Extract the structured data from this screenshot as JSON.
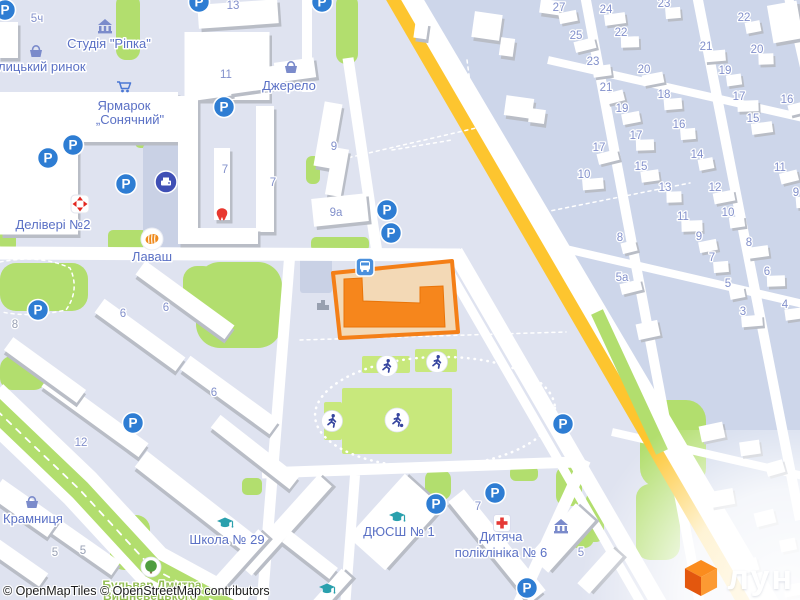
{
  "attribution": {
    "text": "© OpenMapTiles © OpenStreetMap contributors"
  },
  "logo": {
    "text": "лун"
  },
  "map": {
    "colors": {
      "bg": "#dfe3f0",
      "bg2": "#cdd6ea",
      "lot": "#c9d1e5",
      "road": "#ffffff",
      "green": "#b2de6e",
      "field": "#c8e87c",
      "yellow": "#fdc52f",
      "building": "#ffffff",
      "building_shadow": "#b9bdc6",
      "plot_fill": "#f3d9b6",
      "plot_border": "#f47f17",
      "selected_building": "#f6861c",
      "parking_blue": "#2e7dd3",
      "bus_blue": "#4a90dd",
      "poi_slate": "#7b8bcb",
      "cap_teal": "#2aa0ad",
      "red": "#e2261f",
      "navy": "#3f4fb5",
      "figure_navy": "#36459f",
      "label_blue": "#5b71c5",
      "number_blue": "#8290cb",
      "street_green": "#93be53"
    },
    "glyphs": {
      "parking": "P"
    },
    "private_area": "394,-8 810,-8 810,610 752,610",
    "gray_areas": [
      {
        "x": 143,
        "y": 145,
        "w": 45,
        "h": 105
      },
      {
        "x": 300,
        "y": 257,
        "w": 32,
        "h": 36
      }
    ],
    "greens": [
      {
        "x": 336,
        "y": -6,
        "w": 22,
        "h": 70,
        "rx": 10
      },
      {
        "x": 116,
        "y": -6,
        "w": 24,
        "h": 66,
        "rx": 10
      },
      {
        "x": 135,
        "y": 136,
        "w": 30,
        "h": 12,
        "rx": 5
      },
      {
        "x": 196,
        "y": 262,
        "w": 86,
        "h": 86,
        "rx": 24
      },
      {
        "x": 183,
        "y": 266,
        "w": 34,
        "h": 40,
        "rx": 14
      },
      {
        "x": 0,
        "y": 263,
        "w": 88,
        "h": 48,
        "rx": 16
      },
      {
        "x": 0,
        "y": 198,
        "w": 16,
        "h": 54,
        "rx": 7
      },
      {
        "x": 108,
        "y": 230,
        "w": 82,
        "h": 21,
        "rx": 5
      },
      {
        "x": 311,
        "y": 237,
        "w": 58,
        "h": 14,
        "rx": 5
      },
      {
        "x": 306,
        "y": 156,
        "w": 14,
        "h": 28,
        "rx": 6
      },
      {
        "x": 0,
        "y": 356,
        "w": 46,
        "h": 34,
        "rx": 12
      },
      {
        "x": 110,
        "y": 515,
        "w": 40,
        "h": 55,
        "rx": 14
      },
      {
        "x": 242,
        "y": 478,
        "w": 20,
        "h": 17,
        "rx": 5
      },
      {
        "x": 425,
        "y": 470,
        "w": 26,
        "h": 30,
        "rx": 9
      },
      {
        "x": 510,
        "y": 466,
        "w": 28,
        "h": 15,
        "rx": 6
      },
      {
        "x": 556,
        "y": 466,
        "w": 26,
        "h": 40,
        "rx": 10
      },
      {
        "x": 568,
        "y": 516,
        "w": 26,
        "h": 32,
        "rx": 10
      },
      {
        "x": 640,
        "y": 400,
        "w": 66,
        "h": 88,
        "rx": 20
      },
      {
        "x": 636,
        "y": 484,
        "w": 44,
        "h": 76,
        "rx": 14
      },
      {
        "x": 586,
        "y": 492,
        "w": 18,
        "h": 50,
        "rx": 8
      }
    ],
    "roads": [
      {
        "d": "M-5,253 L460,255",
        "w": 13
      },
      {
        "d": "M348,58 L377,253",
        "w": 11
      },
      {
        "d": "M307,-5 L307,92",
        "w": 10
      },
      {
        "d": "M290,252 L262,605",
        "w": 11
      },
      {
        "d": "M355,475 L345,608",
        "w": 10
      },
      {
        "d": "M262,473 L577,462",
        "w": 11
      },
      {
        "d": "M438,252 L642,605",
        "w": 9
      },
      {
        "d": "M455,252 L660,605",
        "w": 16
      },
      {
        "d": "M515,612 L585,460",
        "w": 12
      },
      {
        "d": "M585,-5 L700,605",
        "w": 10
      },
      {
        "d": "M697,-5 L800,520",
        "w": 10
      },
      {
        "d": "M788,-5 L812,100",
        "w": 9
      },
      {
        "d": "M548,60 L812,120",
        "w": 8
      },
      {
        "d": "M553,246 L812,306",
        "w": 8
      },
      {
        "d": "M612,432 L812,478",
        "w": 8
      },
      {
        "d": "M-12,400 L80,488 L152,566 L240,614",
        "w": 44
      },
      {
        "d": "M-12,402 L80,490 L152,568 L238,614",
        "w": 21,
        "c": "green"
      },
      {
        "d": "M402,-8 L766,608",
        "w": 30
      },
      {
        "d": "M389,-8 L747,608",
        "w": 13,
        "c": "yellow"
      },
      {
        "d": "M597,312 L662,452",
        "w": 13,
        "c": "green"
      }
    ],
    "dashes": [
      {
        "d": "M-12,402 L80,490 L152,568 L238,614",
        "w": 1.8,
        "da": "6 7"
      },
      {
        "d": "M467,60 L476,128 L330,162",
        "w": 1.5,
        "da": "3 4"
      },
      {
        "d": "M545,212 L690,183",
        "w": 1.5,
        "da": "3 4"
      },
      {
        "d": "M300,340 L566,332",
        "w": 1.5,
        "da": "3 4"
      },
      {
        "d": "M0,262 Q40,254 70,268 Q80,290 66,310 Q30,318 2,312",
        "w": 1.5,
        "da": "3 4"
      },
      {
        "d": "M392,150 L452,140",
        "w": 1.5,
        "da": "3 4"
      }
    ],
    "buildings": [
      {
        "cx": 89,
        "cy": 117,
        "w": 178,
        "h": 50,
        "r": 0
      },
      {
        "cx": 39,
        "cy": 187,
        "w": 78,
        "h": 95,
        "r": 0
      },
      {
        "cx": 8,
        "cy": 40,
        "w": 20,
        "h": 36,
        "r": 0
      },
      {
        "cx": 227,
        "cy": 66,
        "w": 85,
        "h": 68,
        "r": 0
      },
      {
        "cx": 238,
        "cy": 14,
        "w": 80,
        "h": 24,
        "r": -4
      },
      {
        "cx": 188,
        "cy": 170,
        "w": 20,
        "h": 148,
        "r": 0
      },
      {
        "cx": 265,
        "cy": 169,
        "w": 18,
        "h": 126,
        "r": 0
      },
      {
        "cx": 228,
        "cy": 236,
        "w": 60,
        "h": 16,
        "r": 0
      },
      {
        "cx": 222,
        "cy": 184,
        "w": 16,
        "h": 72,
        "r": 0
      },
      {
        "cx": 213,
        "cy": 84,
        "w": 34,
        "h": 28,
        "r": -8
      },
      {
        "cx": 252,
        "cy": 80,
        "w": 50,
        "h": 22,
        "r": -8
      },
      {
        "cx": 295,
        "cy": 70,
        "w": 40,
        "h": 20,
        "r": -8
      },
      {
        "cx": 328,
        "cy": 135,
        "w": 18,
        "h": 65,
        "r": 10
      },
      {
        "cx": 337,
        "cy": 172,
        "w": 16,
        "h": 48,
        "r": 10
      },
      {
        "cx": 340,
        "cy": 210,
        "w": 55,
        "h": 28,
        "r": -6
      },
      {
        "cx": 487,
        "cy": 26,
        "w": 28,
        "h": 26,
        "r": 8
      },
      {
        "cx": 507,
        "cy": 47,
        "w": 14,
        "h": 18,
        "r": 8
      },
      {
        "cx": 421,
        "cy": 30,
        "w": 13,
        "h": 17,
        "r": 8
      },
      {
        "cx": 519,
        "cy": 107,
        "w": 28,
        "h": 20,
        "r": 8
      },
      {
        "cx": 537,
        "cy": 116,
        "w": 16,
        "h": 14,
        "r": 8
      },
      {
        "cx": 550,
        "cy": 7,
        "w": 20,
        "h": 14,
        "r": 8
      },
      {
        "cx": 785,
        "cy": 22,
        "w": 30,
        "h": 38,
        "r": -10
      },
      {
        "cx": 185,
        "cy": 300,
        "w": 110,
        "h": 17,
        "r": 36
      },
      {
        "cx": 140,
        "cy": 335,
        "w": 100,
        "h": 17,
        "r": 36
      },
      {
        "cx": 230,
        "cy": 395,
        "w": 110,
        "h": 17,
        "r": 36
      },
      {
        "cx": 95,
        "cy": 415,
        "w": 120,
        "h": 17,
        "r": 36
      },
      {
        "cx": 45,
        "cy": 370,
        "w": 90,
        "h": 16,
        "r": 36
      },
      {
        "cx": 75,
        "cy": 540,
        "w": 100,
        "h": 16,
        "r": 35
      },
      {
        "cx": 15,
        "cy": 560,
        "w": 70,
        "h": 16,
        "r": 35
      },
      {
        "cx": 25,
        "cy": 508,
        "w": 70,
        "h": 22,
        "r": 35
      },
      {
        "cx": 200,
        "cy": 505,
        "w": 150,
        "h": 20,
        "r": 38
      },
      {
        "cx": 255,
        "cy": 452,
        "w": 100,
        "h": 16,
        "r": 38
      },
      {
        "cx": 285,
        "cy": 525,
        "w": 120,
        "h": 18,
        "r": -48
      },
      {
        "cx": 240,
        "cy": 560,
        "w": 70,
        "h": 14,
        "r": -48
      },
      {
        "cx": 310,
        "cy": 555,
        "w": 60,
        "h": 14,
        "r": 38
      },
      {
        "cx": 330,
        "cy": 592,
        "w": 50,
        "h": 14,
        "r": -48
      },
      {
        "cx": 395,
        "cy": 522,
        "w": 85,
        "h": 50,
        "r": -48
      },
      {
        "cx": 497,
        "cy": 546,
        "w": 130,
        "h": 20,
        "r": 51
      },
      {
        "cx": 562,
        "cy": 538,
        "w": 70,
        "h": 26,
        "r": -48
      },
      {
        "cx": 600,
        "cy": 570,
        "w": 50,
        "h": 16,
        "r": -48
      }
    ],
    "houses": [
      {
        "cx": 712,
        "cy": 432,
        "w": 24,
        "h": 16,
        "r": -12
      },
      {
        "cx": 750,
        "cy": 448,
        "w": 20,
        "h": 14,
        "r": -8
      },
      {
        "cx": 775,
        "cy": 468,
        "w": 18,
        "h": 13,
        "r": -16
      },
      {
        "cx": 722,
        "cy": 498,
        "w": 24,
        "h": 16,
        "r": -10
      },
      {
        "cx": 765,
        "cy": 518,
        "w": 20,
        "h": 14,
        "r": -14
      },
      {
        "cx": 788,
        "cy": 545,
        "w": 16,
        "h": 12,
        "r": -12
      },
      {
        "cx": 748,
        "cy": 566,
        "w": 20,
        "h": 13,
        "r": -16
      },
      {
        "cx": 793,
        "cy": 590,
        "w": 18,
        "h": 12,
        "r": -10
      },
      {
        "cx": 648,
        "cy": 330,
        "w": 22,
        "h": 16,
        "r": -12
      }
    ],
    "selection": {
      "plot": "333,273 452,261 458,332 340,338",
      "building": "344,279 362,278 363,301 420,303 420,287 443,286 445,327 344,327"
    },
    "stadium": {
      "track": {
        "cx": 435,
        "cy": 412,
        "rx": 120,
        "ry": 55,
        "rot": -2
      },
      "fields": [
        {
          "x": 342,
          "y": 388,
          "w": 110,
          "h": 66
        },
        {
          "x": 362,
          "y": 356,
          "w": 48,
          "h": 17
        },
        {
          "x": 415,
          "y": 349,
          "w": 42,
          "h": 23
        },
        {
          "x": 324,
          "y": 402,
          "w": 18,
          "h": 38
        }
      ]
    },
    "icons": [
      {
        "t": "parking",
        "x": 5,
        "y": 10
      },
      {
        "t": "parking",
        "x": 199,
        "y": 2
      },
      {
        "t": "parking",
        "x": 322,
        "y": 2
      },
      {
        "t": "parking",
        "x": 224,
        "y": 107
      },
      {
        "t": "parking",
        "x": 73,
        "y": 145
      },
      {
        "t": "parking",
        "x": 48,
        "y": 158
      },
      {
        "t": "parking",
        "x": 126,
        "y": 184
      },
      {
        "t": "parking",
        "x": 387,
        "y": 210
      },
      {
        "t": "parking",
        "x": 391,
        "y": 233
      },
      {
        "t": "parking",
        "x": 38,
        "y": 310
      },
      {
        "t": "parking",
        "x": 133,
        "y": 423
      },
      {
        "t": "parking",
        "x": 563,
        "y": 424
      },
      {
        "t": "parking",
        "x": 436,
        "y": 504
      },
      {
        "t": "parking",
        "x": 495,
        "y": 493
      },
      {
        "t": "parking",
        "x": 527,
        "y": 588
      },
      {
        "t": "bus",
        "x": 365,
        "y": 267
      },
      {
        "t": "basket",
        "x": 36,
        "y": 51
      },
      {
        "t": "basket",
        "x": 291,
        "y": 67
      },
      {
        "t": "basket",
        "x": 32,
        "y": 502
      },
      {
        "t": "museum",
        "x": 105,
        "y": 27
      },
      {
        "t": "museum",
        "x": 561,
        "y": 527
      },
      {
        "t": "cart",
        "x": 124,
        "y": 87
      },
      {
        "t": "cap",
        "x": 225,
        "y": 523
      },
      {
        "t": "cap",
        "x": 397,
        "y": 517
      },
      {
        "t": "cap",
        "x": 327,
        "y": 589
      },
      {
        "t": "cross",
        "x": 502,
        "y": 523
      },
      {
        "t": "tooth",
        "x": 222,
        "y": 214
      },
      {
        "t": "tree",
        "x": 151,
        "y": 567
      },
      {
        "t": "printer",
        "x": 166,
        "y": 182
      },
      {
        "t": "delivery",
        "x": 80,
        "y": 204
      },
      {
        "t": "food",
        "x": 152,
        "y": 239
      },
      {
        "t": "runner",
        "x": 387,
        "y": 366
      },
      {
        "t": "runner",
        "x": 437,
        "y": 362
      },
      {
        "t": "runner",
        "x": 332,
        "y": 421
      },
      {
        "t": "footballer",
        "x": 397,
        "y": 420
      },
      {
        "t": "graybuilding",
        "x": 323,
        "y": 304
      }
    ],
    "labels": [
      {
        "text": "Студія \"Ріпка\"",
        "x": 109,
        "y": 48
      },
      {
        "text": "Галицький ринок",
        "x": 35,
        "y": 71
      },
      {
        "text": "Ярмарок",
        "x": 124,
        "y": 110
      },
      {
        "text": "„Сонячний\"",
        "x": 130,
        "y": 124
      },
      {
        "text": "Джерело",
        "x": 289,
        "y": 90
      },
      {
        "text": "Делівері №2",
        "x": 53,
        "y": 229
      },
      {
        "text": "Лаваш",
        "x": 152,
        "y": 261
      },
      {
        "text": "Крамниця",
        "x": 33,
        "y": 523
      },
      {
        "text": "Школа № 29",
        "x": 227,
        "y": 544
      },
      {
        "text": "ДЮСШ № 1",
        "x": 399,
        "y": 536
      },
      {
        "text": "Дитяча",
        "x": 501,
        "y": 541
      },
      {
        "text": "поліклініка № 6",
        "x": 501,
        "y": 557
      }
    ],
    "streets": [
      {
        "text": "Бульвар Дмитра",
        "x": 152,
        "y": 589
      },
      {
        "text": "Вишневецького",
        "x": 150,
        "y": 600
      }
    ],
    "numbers": [
      {
        "t": "5ч",
        "x": 37,
        "y": 22
      },
      {
        "t": "13",
        "x": 233,
        "y": 9
      },
      {
        "t": "11",
        "x": 226,
        "y": 78
      },
      {
        "t": "9",
        "x": 334,
        "y": 150
      },
      {
        "t": "9а",
        "x": 336,
        "y": 216
      },
      {
        "t": "7",
        "x": 225,
        "y": 173
      },
      {
        "t": "7",
        "x": 273,
        "y": 186
      },
      {
        "t": "6",
        "x": 123,
        "y": 317
      },
      {
        "t": "6",
        "x": 166,
        "y": 311
      },
      {
        "t": "6",
        "x": 214,
        "y": 396
      },
      {
        "t": "8",
        "x": 15,
        "y": 328,
        "g": 1
      },
      {
        "t": "12",
        "x": 81,
        "y": 446
      },
      {
        "t": "7",
        "x": 478,
        "y": 510
      },
      {
        "t": "5",
        "x": 581,
        "y": 556
      },
      {
        "t": "5",
        "x": 55,
        "y": 556,
        "g": 1
      },
      {
        "t": "5",
        "x": 83,
        "y": 554,
        "g": 1
      },
      {
        "t": "27",
        "x": 559,
        "y": 11,
        "h": 1
      },
      {
        "t": "24",
        "x": 606,
        "y": 13,
        "h": 1
      },
      {
        "t": "23",
        "x": 664,
        "y": 7,
        "h": 1
      },
      {
        "t": "22",
        "x": 621,
        "y": 36,
        "h": 1
      },
      {
        "t": "25",
        "x": 576,
        "y": 39,
        "h": 1
      },
      {
        "t": "22",
        "x": 744,
        "y": 21,
        "h": 1
      },
      {
        "t": "23",
        "x": 593,
        "y": 65,
        "h": 1
      },
      {
        "t": "21",
        "x": 706,
        "y": 50,
        "h": 1
      },
      {
        "t": "20",
        "x": 757,
        "y": 53,
        "h": 1
      },
      {
        "t": "21",
        "x": 606,
        "y": 91,
        "h": 1
      },
      {
        "t": "20",
        "x": 644,
        "y": 73,
        "h": 1
      },
      {
        "t": "19",
        "x": 725,
        "y": 74,
        "h": 1
      },
      {
        "t": "18",
        "x": 664,
        "y": 98,
        "h": 1
      },
      {
        "t": "17",
        "x": 739,
        "y": 100,
        "h": 1
      },
      {
        "t": "16",
        "x": 787,
        "y": 103,
        "h": 1
      },
      {
        "t": "19",
        "x": 622,
        "y": 112,
        "h": 1
      },
      {
        "t": "15",
        "x": 753,
        "y": 122,
        "h": 1
      },
      {
        "t": "16",
        "x": 679,
        "y": 128,
        "h": 1
      },
      {
        "t": "17",
        "x": 636,
        "y": 139,
        "h": 1
      },
      {
        "t": "17",
        "x": 599,
        "y": 151,
        "h": 1
      },
      {
        "t": "14",
        "x": 697,
        "y": 158,
        "h": 1
      },
      {
        "t": "15",
        "x": 641,
        "y": 170,
        "h": 1
      },
      {
        "t": "10",
        "x": 584,
        "y": 178,
        "h": 1
      },
      {
        "t": "13",
        "x": 665,
        "y": 191,
        "h": 1
      },
      {
        "t": "11",
        "x": 780,
        "y": 171,
        "h": 1
      },
      {
        "t": "12",
        "x": 715,
        "y": 191,
        "h": 1
      },
      {
        "t": "10",
        "x": 728,
        "y": 216,
        "h": 1
      },
      {
        "t": "9",
        "x": 796,
        "y": 196,
        "h": 1
      },
      {
        "t": "11",
        "x": 683,
        "y": 220,
        "h": 1
      },
      {
        "t": "8",
        "x": 620,
        "y": 241,
        "h": 1
      },
      {
        "t": "9",
        "x": 699,
        "y": 240,
        "h": 1
      },
      {
        "t": "8",
        "x": 749,
        "y": 246,
        "h": 1
      },
      {
        "t": "7",
        "x": 712,
        "y": 261,
        "h": 1
      },
      {
        "t": "6",
        "x": 767,
        "y": 275,
        "h": 1
      },
      {
        "t": "5а",
        "x": 622,
        "y": 281,
        "h": 1
      },
      {
        "t": "5",
        "x": 728,
        "y": 287,
        "h": 1
      },
      {
        "t": "4",
        "x": 785,
        "y": 308,
        "h": 1
      },
      {
        "t": "3",
        "x": 743,
        "y": 315,
        "h": 1
      }
    ]
  }
}
